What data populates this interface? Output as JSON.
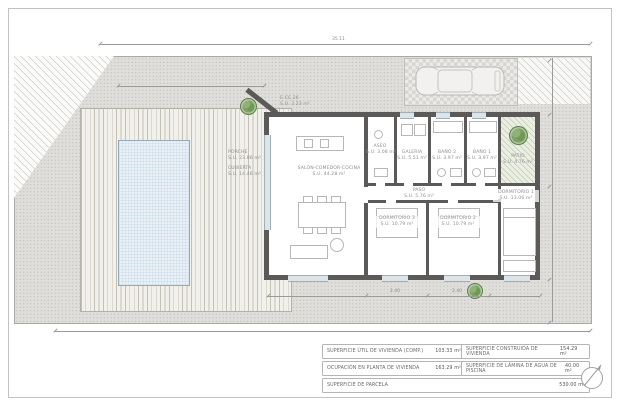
{
  "drawing": {
    "type": "floor-plan",
    "language": "es"
  },
  "colors": {
    "wall": "#5b5a58",
    "pool_fill": "#e9f1f7",
    "pool_edge": "#93abbc",
    "deck": "#f1f0ea",
    "gravel": "#dfdedb",
    "tree_green": "#6f9a55",
    "dim_gray": "#9a9a9a"
  },
  "rooms": [
    {
      "name": "SALÓN-COMEDOR-COCINA",
      "area": "S.U. 44.28 m²"
    },
    {
      "name": "ASEO",
      "area": "S.U. 3.08 m²"
    },
    {
      "name": "GALERIA",
      "area": "S.U. 5.51 m²"
    },
    {
      "name": "BAÑO 2",
      "area": "S.U. 3.97 m²"
    },
    {
      "name": "BAÑO 1",
      "area": "S.U. 3.97 m²"
    },
    {
      "name": "PATIO",
      "area": "S.U. 4.76 m²"
    },
    {
      "name": "PASO",
      "area": "S.U. 5.76 m²"
    },
    {
      "name": "DORMITORIO 3",
      "area": "S.U. 10.79 m²"
    },
    {
      "name": "DORMITORIO 2",
      "area": "S.U. 10.79 m²"
    },
    {
      "name": "DORMITORIO 1",
      "area": "S.U. 13.06 m²"
    },
    {
      "name": "PORCHE",
      "area": "S.U. 23.86 m²"
    },
    {
      "name": "CUBIERTA",
      "area": "S.U. 14.46 m²"
    },
    {
      "name": "E.CC.26",
      "area": "S.U. 3.23 m²"
    }
  ],
  "dimensions": {
    "overall_width": "35.11",
    "dorm3_width": "2.40",
    "dorm2_width": "2.40"
  },
  "summary_table": {
    "rows": [
      {
        "label": "SUPERFICIE ÚTIL DE VIVIENDA (COMP.)",
        "value": "103.33 m²"
      },
      {
        "label": "SUPERFICIE CONSTRUIDA DE VIVIENDA",
        "value": "154.29 m²"
      },
      {
        "label": "OCUPACIÓN EN PLANTA DE VIVIENDA",
        "value": "163.29 m²"
      },
      {
        "label": "SUPERFICIE DE LÁMINA DE AGUA DE PISCINA",
        "value": "40.00 m²"
      },
      {
        "label": "SUPERFICIE DE PARCELA",
        "value": "530.00 m²"
      }
    ]
  },
  "symbols": {
    "north_arrow": "north-arrow",
    "car": "car-top-view",
    "trees": "garden-trees"
  }
}
